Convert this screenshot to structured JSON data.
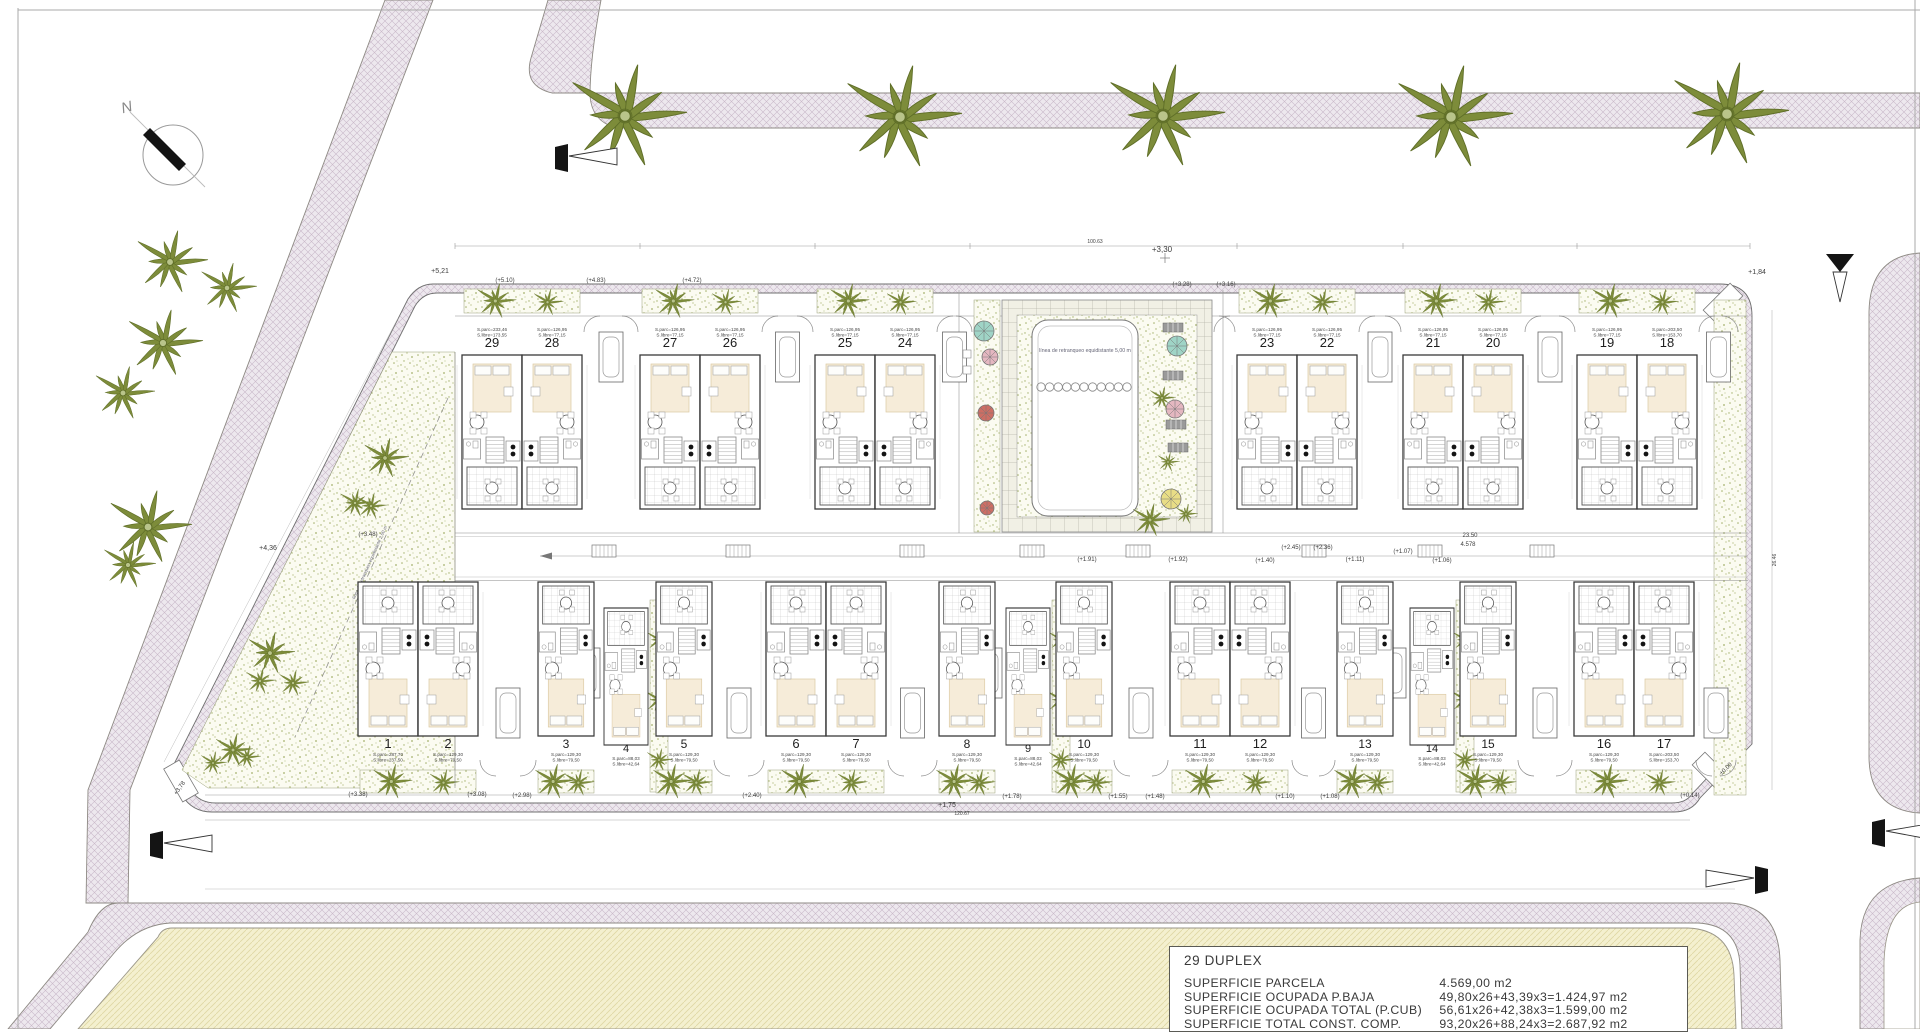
{
  "compass": {
    "north_label": "N"
  },
  "pool": {
    "setback_text": "línea de retranqueo equidistante 5,00 m",
    "setback_text_left": "línea de retranqueo equidistante 2,00 m"
  },
  "units": {
    "top_default": {
      "p": "S.parc=126,95",
      "li": "S.libre=77,15"
    },
    "bottom_default": {
      "p": "S.parc=129,30",
      "li": "S.libre=79,50"
    },
    "top_pairs": [
      {
        "x": 462,
        "l": {
          "n": "29",
          "p": "S.parc=233,46",
          "li": "S.libre=173,55"
        },
        "r": {
          "n": "28"
        }
      },
      {
        "x": 640,
        "l": {
          "n": "27"
        },
        "r": {
          "n": "26"
        }
      },
      {
        "x": 815,
        "l": {
          "n": "25"
        },
        "r": {
          "n": "24"
        }
      },
      {
        "x": 1237,
        "l": {
          "n": "23"
        },
        "r": {
          "n": "22"
        }
      },
      {
        "x": 1403,
        "l": {
          "n": "21"
        },
        "r": {
          "n": "20"
        }
      },
      {
        "x": 1577,
        "l": {
          "n": "19"
        },
        "r": {
          "n": "18",
          "p": "S.parc=203,50",
          "li": "S.libre=153,70"
        }
      }
    ],
    "bottom_row": [
      {
        "type": "pair",
        "x": 358,
        "l": {
          "n": "1",
          "p": "S.parc=287,70",
          "li": "S.libre=237,50"
        },
        "r": {
          "n": "2"
        }
      },
      {
        "type": "single",
        "x": 538,
        "n": "3"
      },
      {
        "type": "offset",
        "x": 604,
        "n": "4",
        "p": "S.parc=88,03",
        "li": "S.libre=42,64"
      },
      {
        "type": "single",
        "x": 656,
        "n": "5"
      },
      {
        "type": "pair",
        "x": 766,
        "l": {
          "n": "6"
        },
        "r": {
          "n": "7"
        }
      },
      {
        "type": "single",
        "x": 939,
        "n": "8"
      },
      {
        "type": "offset",
        "x": 1006,
        "n": "9",
        "p": "S.parc=88,03",
        "li": "S.libre=42,64"
      },
      {
        "type": "single",
        "x": 1056,
        "n": "10"
      },
      {
        "type": "pair",
        "x": 1170,
        "l": {
          "n": "11"
        },
        "r": {
          "n": "12"
        }
      },
      {
        "type": "single",
        "x": 1337,
        "n": "13"
      },
      {
        "type": "offset",
        "x": 1410,
        "n": "14",
        "p": "S.parc=88,03",
        "li": "S.libre=42,64"
      },
      {
        "type": "single",
        "x": 1460,
        "n": "15"
      },
      {
        "type": "pair",
        "x": 1574,
        "l": {
          "n": "16"
        },
        "r": {
          "n": "17",
          "p": "S.parc=203,50",
          "li": "S.libre=153,70"
        }
      }
    ]
  },
  "annotations": [
    {
      "t": "+5,21",
      "x": 440,
      "y": 273,
      "s": 7
    },
    {
      "t": "(+5.10)",
      "x": 505,
      "y": 282,
      "s": 6
    },
    {
      "t": "(+4.83)",
      "x": 596,
      "y": 282,
      "s": 6
    },
    {
      "t": "(+4.72)",
      "x": 692,
      "y": 282,
      "s": 6
    },
    {
      "t": "+3,30",
      "x": 1162,
      "y": 252,
      "s": 8
    },
    {
      "t": "100.63",
      "x": 1095,
      "y": 243,
      "s": 5
    },
    {
      "t": "(+3.28)",
      "x": 1182,
      "y": 286,
      "s": 6
    },
    {
      "t": "(+3.16)",
      "x": 1226,
      "y": 286,
      "s": 6
    },
    {
      "t": "+1,84",
      "x": 1757,
      "y": 274,
      "s": 7
    },
    {
      "t": "(+3.48)",
      "x": 368,
      "y": 536,
      "s": 6
    },
    {
      "t": "+4,36",
      "x": 268,
      "y": 550,
      "s": 7
    },
    {
      "t": "(+1.91)",
      "x": 1087,
      "y": 561,
      "s": 6
    },
    {
      "t": "(+1.92)",
      "x": 1178,
      "y": 561,
      "s": 6
    },
    {
      "t": "(+2.45)",
      "x": 1291,
      "y": 549,
      "s": 6
    },
    {
      "t": "(+2.36)",
      "x": 1323,
      "y": 549,
      "s": 6
    },
    {
      "t": "(+1.40)",
      "x": 1265,
      "y": 562,
      "s": 6
    },
    {
      "t": "(+1.07)",
      "x": 1403,
      "y": 553,
      "s": 6
    },
    {
      "t": "(+1.11)",
      "x": 1355,
      "y": 561,
      "s": 6
    },
    {
      "t": "(+1.06)",
      "x": 1442,
      "y": 562,
      "s": 6
    },
    {
      "t": "23.50",
      "x": 1470,
      "y": 537,
      "s": 6
    },
    {
      "t": "4.578",
      "x": 1468,
      "y": 546,
      "s": 6
    },
    {
      "t": "(+3.38)",
      "x": 358,
      "y": 796,
      "s": 6
    },
    {
      "t": "(+3.08)",
      "x": 477,
      "y": 796,
      "s": 6
    },
    {
      "t": "(+2.98)",
      "x": 522,
      "y": 797,
      "s": 6
    },
    {
      "t": "(+2.40)",
      "x": 752,
      "y": 797,
      "s": 6
    },
    {
      "t": "(+1.78)",
      "x": 1012,
      "y": 798,
      "s": 6
    },
    {
      "t": "(+1.55)",
      "x": 1118,
      "y": 798,
      "s": 6
    },
    {
      "t": "(+1.48)",
      "x": 1155,
      "y": 798,
      "s": 6
    },
    {
      "t": "(+1.10)",
      "x": 1285,
      "y": 798,
      "s": 6
    },
    {
      "t": "(+1.08)",
      "x": 1330,
      "y": 798,
      "s": 6
    },
    {
      "t": "+1,75",
      "x": 947,
      "y": 807,
      "s": 7
    },
    {
      "t": "120.67",
      "x": 962,
      "y": 815,
      "s": 5
    },
    {
      "t": "(+0.14)",
      "x": 1690,
      "y": 797,
      "s": 6
    },
    {
      "t": "±0,00",
      "x": 1727,
      "y": 770,
      "s": 6,
      "r": -45
    },
    {
      "t": "+3,78",
      "x": 181,
      "y": 789,
      "s": 6,
      "r": -55
    },
    {
      "t": "26.46",
      "x": 1776,
      "y": 560,
      "s": 5,
      "r": -90
    }
  ],
  "table": {
    "title": "29 DUPLEX",
    "rows": [
      {
        "label": "SUPERFICIE PARCELA",
        "value": "4.569,00 m2"
      },
      {
        "label": "SUPERFICIE OCUPADA P.BAJA",
        "value": "49,80x26+43,39x3=1.424,97 m2"
      },
      {
        "label": "SUPERFICIE OCUPADA TOTAL (P.CUB)",
        "value": "56,61x26+42,38x3=1.599,00 m2"
      },
      {
        "label": "SUPERFICIE TOTAL CONST. COMP.",
        "value": "93,20x26+88,24x3=2.687,92 m2"
      }
    ]
  },
  "trees": {
    "road_palms": [
      [
        625,
        116
      ],
      [
        900,
        117
      ],
      [
        1163,
        116
      ],
      [
        1451,
        117
      ],
      [
        1727,
        114
      ]
    ],
    "outside_palms": [
      [
        170,
        262,
        1.9
      ],
      [
        227,
        288,
        1.5
      ],
      [
        163,
        343,
        2.0
      ],
      [
        123,
        393,
        1.6
      ],
      [
        148,
        527,
        2.2
      ],
      [
        128,
        565,
        1.4
      ]
    ],
    "site_palms": [
      [
        385,
        458,
        1.2
      ],
      [
        355,
        503,
        0.85
      ],
      [
        371,
        506,
        0.8
      ],
      [
        270,
        653,
        1.25
      ],
      [
        260,
        681,
        0.8
      ],
      [
        293,
        683,
        0.8
      ],
      [
        233,
        750,
        1.0
      ],
      [
        247,
        757,
        0.7
      ],
      [
        213,
        763,
        0.7
      ]
    ],
    "pool_palms": [
      [
        1162,
        398,
        0.7
      ],
      [
        1168,
        462,
        0.6
      ],
      [
        1150,
        520,
        1.0
      ],
      [
        1186,
        514,
        0.6
      ]
    ]
  },
  "pool_features": {
    "umbrellas": [
      [
        984,
        331,
        10,
        "teal"
      ],
      [
        990,
        357,
        8,
        "pink"
      ],
      [
        986,
        413,
        8,
        "red"
      ],
      [
        987,
        508,
        7,
        "red"
      ],
      [
        1177,
        346,
        10,
        "teal"
      ],
      [
        1175,
        409,
        9,
        "pink"
      ],
      [
        1171,
        499,
        10,
        "yellow_u"
      ]
    ],
    "loungers": [
      [
        1163,
        323
      ],
      [
        1163,
        371
      ],
      [
        1166,
        420
      ],
      [
        1168,
        443
      ]
    ],
    "lane_circle_count": 11
  },
  "colors": {
    "road_fill": "#ede8ee",
    "road_hatch": "#c9b8c9",
    "road_edge": "#8e8a84",
    "yellow_fill": "#f4f0cf",
    "yellow_hatch": "#ded7a4",
    "stipple_bg": "#fbfbf1",
    "stipple_dot": "#a3b06b",
    "palm_leaf": "#7d8c3a",
    "palm_dark": "#5f6e28",
    "wall": "#3a3a3a",
    "rug": "#f6ecd9",
    "rug_edge": "#dcc9a2",
    "line": "#777777",
    "text": "#3c3c3c",
    "black": "#141414",
    "teal": "#9fd4c6",
    "pink": "#e4b7c0",
    "red": "#cd6e64",
    "yellow_u": "#e8dd86",
    "lounger": "#9a9a9a"
  }
}
